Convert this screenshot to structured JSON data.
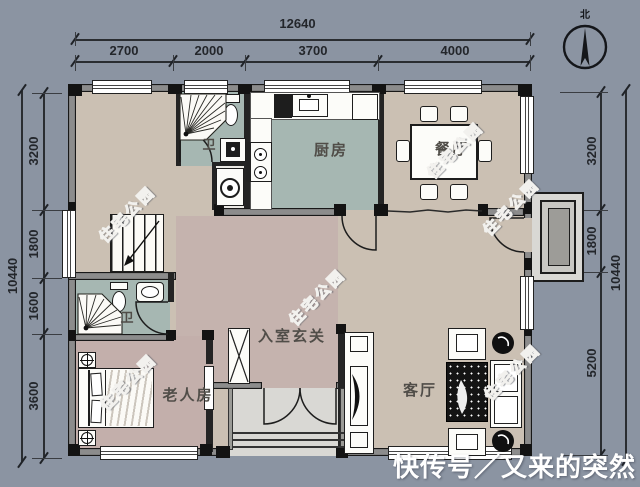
{
  "dims": {
    "top_total": "12640",
    "top_segments": [
      "2700",
      "2000",
      "3700",
      "4000"
    ],
    "left_total": "10440",
    "left_segments": [
      "3200",
      "1800",
      "1600",
      "3600"
    ],
    "right_total": "10440",
    "right_segments": [
      "3200",
      "1800",
      "5200"
    ]
  },
  "rooms": {
    "kitchen": "厨房",
    "dining": "餐厅",
    "bath_top": "卫",
    "bath_lower": "卫",
    "foyer": "入室玄关",
    "elder_bedroom": "老人房",
    "living": "客厅"
  },
  "compass": {
    "north_label": "北"
  },
  "watermark": {
    "text": "住宅公园"
  },
  "footer": {
    "source_text": "快传号／又来的突然"
  },
  "colors": {
    "canvas_background": "#8b94a2",
    "floor_beige": "#cbc0b3",
    "floor_teal": "#a6b7b2",
    "floor_pink": "#c3afab",
    "floor_foyer": "#c5b3ae",
    "porch_gray": "#d9d8d4",
    "wall_gray": "#8c8c8c",
    "wall_dark": "#1d1d1d",
    "dimension_text": "#23262b",
    "watermark_white": "#f2f1ee"
  },
  "icons": {
    "compass-north-icon": "circle with needle pointing north",
    "shower-icon": "corner shower with fan spray lines",
    "toilet-icon": "tank and oval bowl",
    "sink-icon": "oval basin",
    "washing-machine-icon": "square with drum circle",
    "stairs-icon": "treads with direction arrow",
    "bed-icon": "double bed with pillows",
    "sofa-icon": "sofa with cushions",
    "tv-icon": "curved screen lens",
    "dining-table-icon": "table with six chairs",
    "wardrobe-icon": "rectangle with X",
    "door-icon": "quarter-circle swing arc"
  }
}
